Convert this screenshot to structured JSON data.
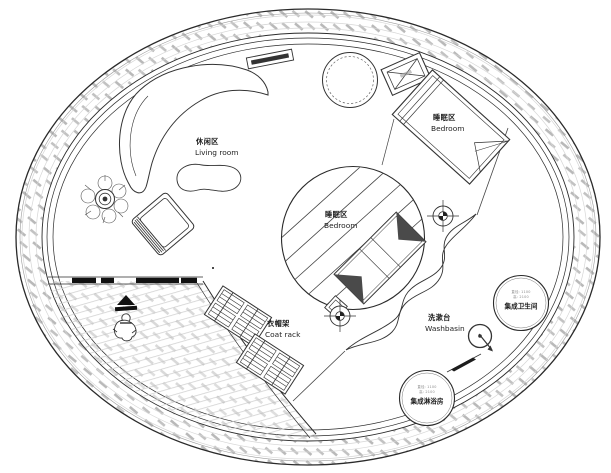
{
  "plan": {
    "labels": {
      "living": {
        "zh": "休闲区",
        "en": "Living room"
      },
      "bedroom_main": {
        "zh": "睡眠区",
        "en": "Bedroom"
      },
      "bedroom_center": {
        "zh": "睡眠区",
        "en": "Bedroom"
      },
      "coat_rack": {
        "zh": "衣帽架",
        "en": "Coat rack"
      },
      "washbasin": {
        "zh": "洗漱台",
        "en": "Washbasin"
      },
      "bathroom_pod": {
        "spec1": "直径: 1100",
        "spec2": "高: 2100",
        "name": "集成卫生间"
      },
      "shower_pod": {
        "spec1": "直径: 1100",
        "spec2": "高: 2100",
        "name": "集成淋浴房"
      }
    },
    "colors": {
      "line": "#2a2a2a",
      "wall_hatch": "#b9b9b9",
      "deck_hatch": "#cfcfcf",
      "text": "#1c1c1c",
      "spec_text": "#8a8a8a"
    }
  }
}
